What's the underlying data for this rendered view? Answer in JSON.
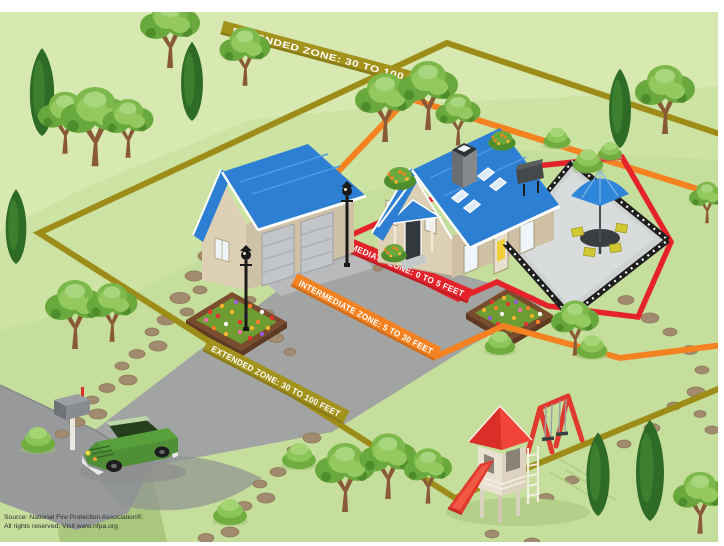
{
  "zone_labels": {
    "extended_top": "EXTENDED ZONE:  30 TO 100 FEET",
    "immediate": "IMMEDIATE ZONE:  0 TO 5 FEET",
    "intermediate": "INTERMEDIATE ZONE:  5 TO 30 FEET",
    "extended_bottom": "EXTENDED ZONE:  30 TO 100 FEET"
  },
  "colors": {
    "immediate": "#e5232b",
    "intermediate": "#f58220",
    "extended": "#a3921c",
    "roof_blue": "#2d7fd4",
    "grass": "#c6de9b"
  },
  "source": {
    "line1": "Source: National Fire Protection Association®.",
    "line2": "All rights reserved. Visit www.nfpa.org"
  }
}
